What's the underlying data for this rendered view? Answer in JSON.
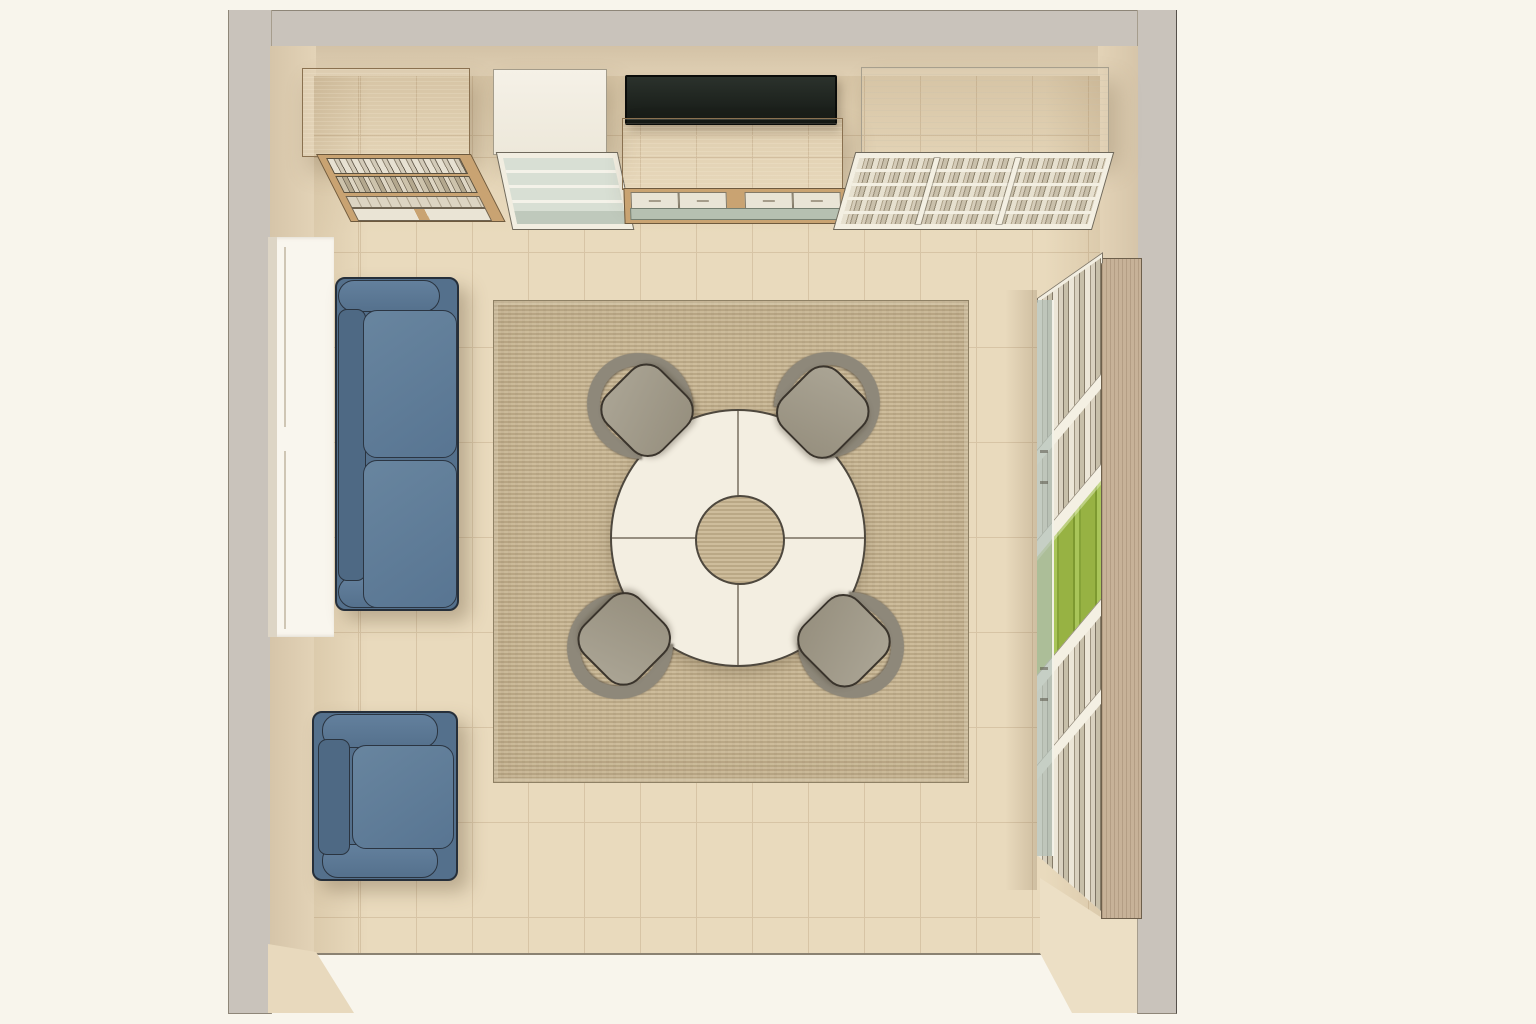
{
  "scene": {
    "title": "Top-down 3D room rendering",
    "description": "Bird's-eye architectural render of a square room: blue two-seat sofa and armchair on the left beside a window, round white four-segment table with center cutout and four gray chairs on a woven rug, wooden and white book cabinets with a TV console along the top wall, and a tall shelving unit with books and green storage boxes along the right wall.",
    "visible_text": []
  },
  "colors": {
    "background": "#f8f5ec",
    "wall_outer": "#c9c3bb",
    "wall_inner": "#ddccb1",
    "wall_inner2": "#e8d9bd",
    "floor": "#e9dabd",
    "floor_line": "#d7c4a5",
    "window": "#f9f6ee",
    "rug": "#c8b694",
    "table_top": "#f3eee1",
    "chair_seat": "#a7a193",
    "chair_back": "#8e887a",
    "sofa_base": "#54708c",
    "sofa_back": "#4e6984",
    "sofa_cushion": "#68859f",
    "wood": "#d8b586",
    "wood_frame": "#c9a372",
    "white_panel": "#f3efe2",
    "glass": "#d8dfd4",
    "green_box": "#97b243",
    "tv": "#1c211c"
  },
  "furniture": [
    {
      "name": "wood-bookshelf",
      "label": "oak cabinet with book shelves"
    },
    {
      "name": "glass-cabinet",
      "label": "white display cabinet with glass shelves"
    },
    {
      "name": "tv",
      "label": "flat-screen TV"
    },
    {
      "name": "media-console",
      "label": "wooden console with four drawers"
    },
    {
      "name": "white-bookshelf",
      "label": "white cabinet with three book columns"
    },
    {
      "name": "window",
      "label": "window recess in left wall"
    },
    {
      "name": "sofa",
      "label": "blue two-seat sofa"
    },
    {
      "name": "armchair",
      "label": "blue armchair"
    },
    {
      "name": "rug",
      "label": "woven area rug"
    },
    {
      "name": "round-table",
      "label": "round segmented table with center opening"
    },
    {
      "name": "chair",
      "label": "gray shell chair",
      "count": 4
    },
    {
      "name": "tall-shelf",
      "label": "tall wall shelf with books and green boxes"
    }
  ]
}
